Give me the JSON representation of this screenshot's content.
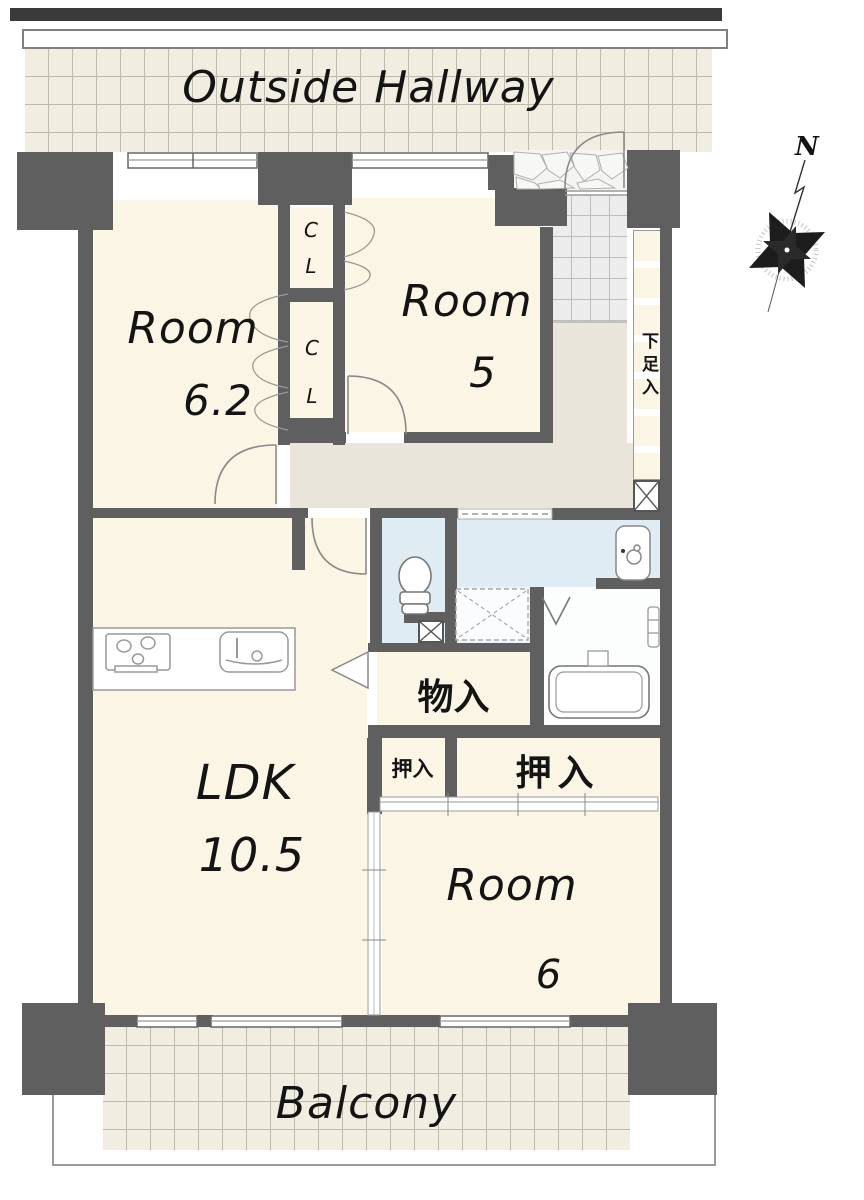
{
  "outside_hallway": {
    "label": "Outside Hallway"
  },
  "compass": {
    "label": "N"
  },
  "rooms": {
    "room_62": {
      "name": "Room",
      "size": "6.2"
    },
    "room_5": {
      "name": "Room",
      "size": "5"
    },
    "ldk": {
      "name": "LDK",
      "size": "10.5"
    },
    "room_6": {
      "name": "Room",
      "size": "6"
    }
  },
  "storage": {
    "closet_top": {
      "line1": "C",
      "line2": "L"
    },
    "closet_bottom": {
      "line1": "C",
      "line2": "L"
    },
    "shoe_cabinet": "下足入",
    "storage_room": "物入",
    "futon_closet_small": "押入",
    "futon_closet_large": "押入"
  },
  "balcony": {
    "label": "Balcony"
  },
  "colors": {
    "wall": "#5f5f5f",
    "room_floor": "#faf5e4",
    "hallway_floor": "#e9e5db",
    "wet_area_floor": "#dfecf4",
    "tile_background": "#f1ede1",
    "text": "#141414"
  }
}
